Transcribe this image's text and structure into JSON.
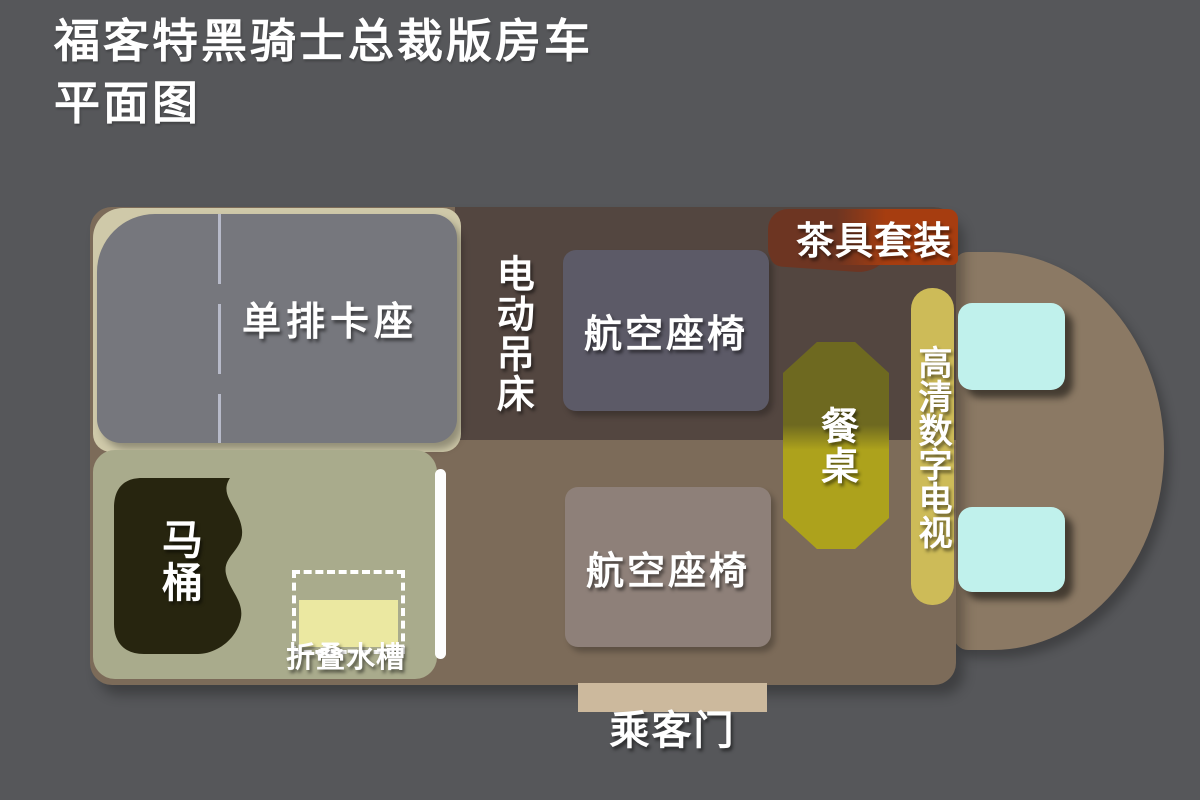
{
  "title": {
    "line1": "福客特黑骑士总裁版房车",
    "line2": "平面图"
  },
  "plan": {
    "booth_label": "单排卡座",
    "electric_bed_label": "电动吊床",
    "aviation_seat_top_label": "航空座椅",
    "aviation_seat_bottom_label": "航空座椅",
    "tea_set_label": "茶具套装",
    "dining_table_label": "餐桌",
    "tv_label": "高清数字电视",
    "toilet_label": "马桶",
    "folding_sink_label": "折叠水槽",
    "passenger_door_label": "乘客门"
  },
  "colors": {
    "background": "#56575a",
    "body": "#7c6b59",
    "bed-area": "#534640",
    "cab": "#8b7964",
    "pad": "#cfc9a9",
    "booth": "#76777d",
    "booth-divider": "#b7bac9",
    "seat-top": "#5c5a67",
    "seat-bottom": "#8e8079",
    "tea-dark": "#6d3522",
    "tea-bright": "#a63d10",
    "table-dark": "#6e6920",
    "table-bright": "#ada21c",
    "tv-strip": "#cdbb58",
    "cab-seat": "#c0f1ec",
    "bathroom": "#a9ab8c",
    "toilet": "#27250f",
    "sink": "#ebe8a1",
    "door": "#ccb99d",
    "label": "#ffffff"
  }
}
